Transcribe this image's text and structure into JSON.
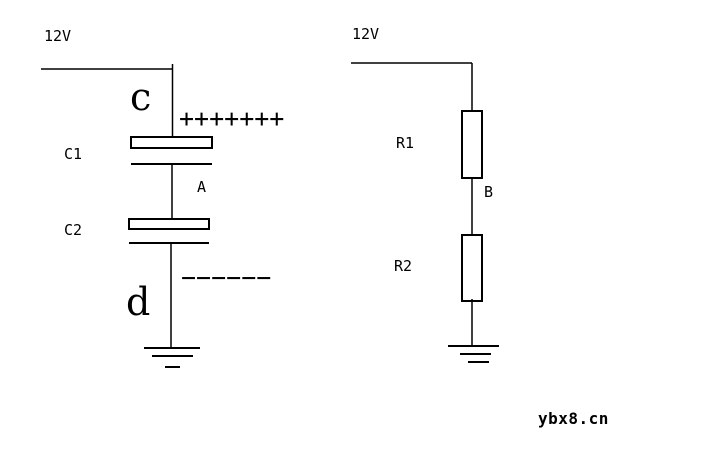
{
  "page": {
    "background_color": "#ffffff",
    "ink_color": "#000000"
  },
  "left_circuit": {
    "supply_label": "12V",
    "top_plate_point_label": "c",
    "capacitor1_label": "C1",
    "midpoint_label": "A",
    "capacitor2_label": "C2",
    "bottom_plate_point_label": "d",
    "positive_charges": "+++++++",
    "negative_charges": "−−−−−−"
  },
  "right_circuit": {
    "supply_label": "12V",
    "resistor1_label": "R1",
    "midpoint_label": "B",
    "resistor2_label": "R2"
  },
  "watermark": {
    "text": "ybx8.cn"
  }
}
